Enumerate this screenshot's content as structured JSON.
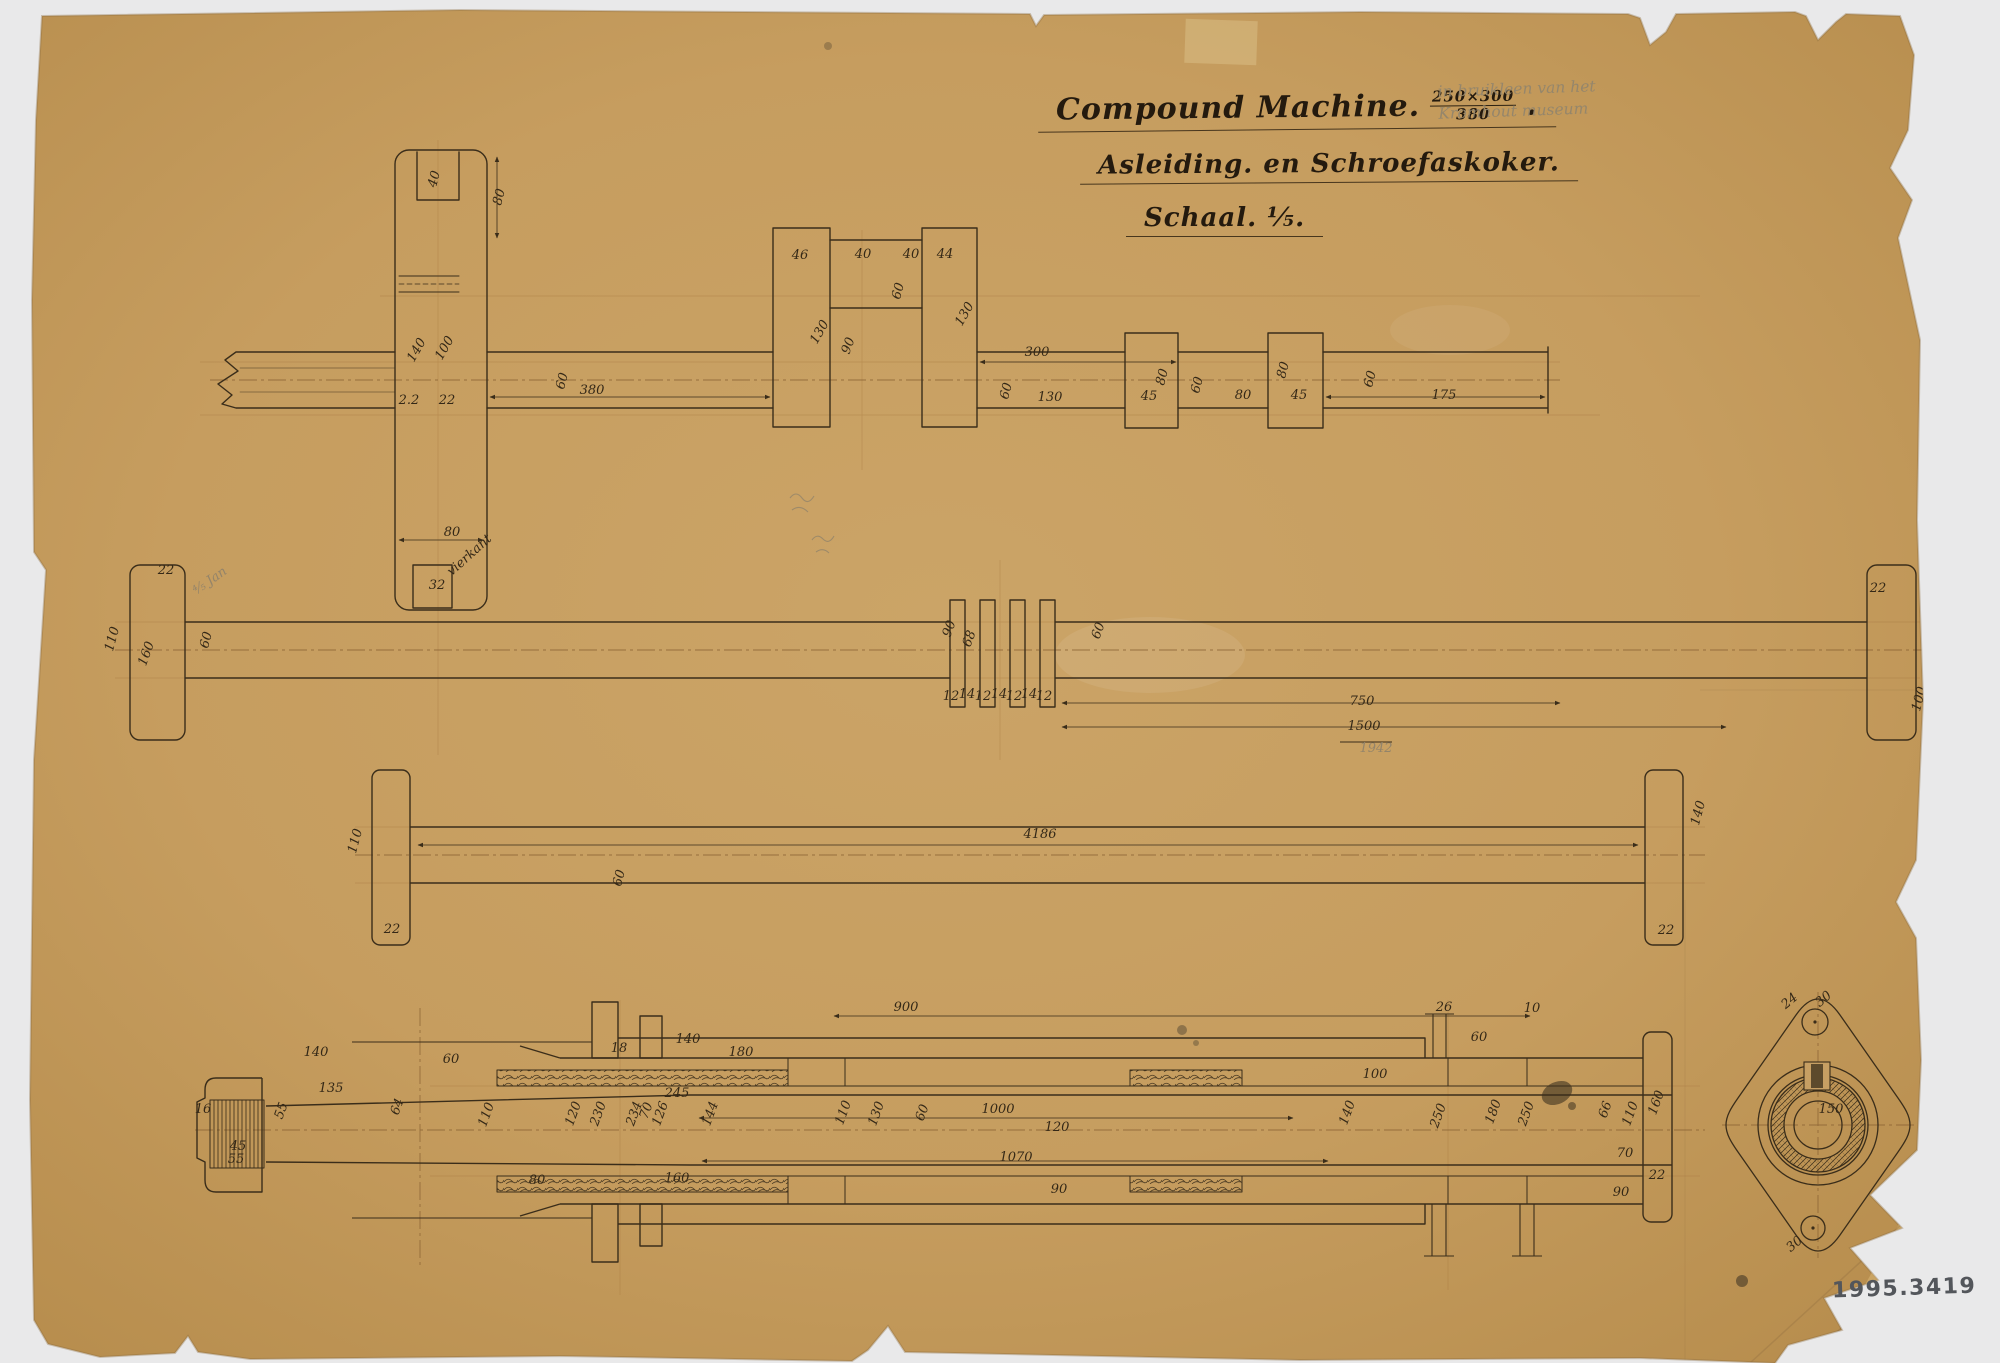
{
  "meta": {
    "inventory_number": "1995.3419"
  },
  "title": {
    "line1": "Compound Machine.",
    "fraction_top": "250×300",
    "fraction_bottom": "380",
    "line1_suffix": ".",
    "line2": "Asleiding. en Schroefaskoker.",
    "line3": "Schaal. ⅕."
  },
  "pencil_note": {
    "line1": "in bruikleen van het",
    "line2": "Kromhout museum"
  },
  "colors": {
    "paper": "#c79f63",
    "ink": "#3a2d1a",
    "pencil": "#93846a",
    "faint_line": "#a5763d"
  },
  "annotations": [
    {
      "t": "40",
      "x": 438,
      "y": 180,
      "r": -75
    },
    {
      "t": "80",
      "x": 503,
      "y": 198,
      "r": -75
    },
    {
      "t": "140",
      "x": 420,
      "y": 352,
      "r": -60
    },
    {
      "t": "100",
      "x": 448,
      "y": 350,
      "r": -60
    },
    {
      "t": "2.2",
      "x": 409,
      "y": 404
    },
    {
      "t": "22",
      "x": 447,
      "y": 404
    },
    {
      "t": "80",
      "x": 452,
      "y": 536
    },
    {
      "t": "32",
      "x": 437,
      "y": 589
    },
    {
      "t": "vierkant",
      "x": 472,
      "y": 558,
      "r": -42,
      "s": 9
    },
    {
      "t": "60",
      "x": 566,
      "y": 382,
      "r": -75
    },
    {
      "t": "380",
      "x": 592,
      "y": 394
    },
    {
      "t": "46",
      "x": 800,
      "y": 259
    },
    {
      "t": "40",
      "x": 863,
      "y": 258
    },
    {
      "t": "40",
      "x": 911,
      "y": 258
    },
    {
      "t": "44",
      "x": 945,
      "y": 258
    },
    {
      "t": "60",
      "x": 902,
      "y": 292,
      "r": -75
    },
    {
      "t": "130",
      "x": 823,
      "y": 334,
      "r": -60
    },
    {
      "t": "90",
      "x": 852,
      "y": 347,
      "r": -70
    },
    {
      "t": "130",
      "x": 968,
      "y": 316,
      "r": -60
    },
    {
      "t": "300",
      "x": 1037,
      "y": 356
    },
    {
      "t": "60",
      "x": 1010,
      "y": 392,
      "r": -75
    },
    {
      "t": "130",
      "x": 1050,
      "y": 401
    },
    {
      "t": "45",
      "x": 1149,
      "y": 400
    },
    {
      "t": "80",
      "x": 1166,
      "y": 378,
      "r": -75
    },
    {
      "t": "60",
      "x": 1201,
      "y": 386,
      "r": -75
    },
    {
      "t": "80",
      "x": 1243,
      "y": 399
    },
    {
      "t": "45",
      "x": 1299,
      "y": 399
    },
    {
      "t": "80",
      "x": 1287,
      "y": 371,
      "r": -75
    },
    {
      "t": "60",
      "x": 1374,
      "y": 380,
      "r": -75
    },
    {
      "t": "175",
      "x": 1444,
      "y": 399
    },
    {
      "t": "110",
      "x": 116,
      "y": 640,
      "r": -75
    },
    {
      "t": "22",
      "x": 166,
      "y": 574
    },
    {
      "t": "160",
      "x": 150,
      "y": 655,
      "r": -70
    },
    {
      "t": "60",
      "x": 210,
      "y": 641,
      "r": -75
    },
    {
      "t": "90",
      "x": 953,
      "y": 630,
      "r": -70
    },
    {
      "t": "68",
      "x": 973,
      "y": 640,
      "r": -70
    },
    {
      "t": "12",
      "x": 951,
      "y": 700,
      "s": 10
    },
    {
      "t": "14",
      "x": 967,
      "y": 698,
      "s": 10
    },
    {
      "t": "12",
      "x": 983,
      "y": 700,
      "s": 10
    },
    {
      "t": "14",
      "x": 999,
      "y": 698,
      "s": 10
    },
    {
      "t": "12",
      "x": 1014,
      "y": 700,
      "s": 10
    },
    {
      "t": "14",
      "x": 1029,
      "y": 698,
      "s": 10
    },
    {
      "t": "12",
      "x": 1044,
      "y": 700,
      "s": 10
    },
    {
      "t": "60",
      "x": 1102,
      "y": 632,
      "r": -70
    },
    {
      "t": "750",
      "x": 1362,
      "y": 705
    },
    {
      "t": "1500",
      "x": 1364,
      "y": 730
    },
    {
      "t": "1942",
      "x": 1376,
      "y": 752,
      "cls": "pencil",
      "s": 11
    },
    {
      "t": "⅘ Jan",
      "x": 212,
      "y": 584,
      "r": -35,
      "cls": "pencil",
      "s": 11
    },
    {
      "t": "22",
      "x": 1878,
      "y": 592
    },
    {
      "t": "100",
      "x": 1923,
      "y": 700,
      "r": -75
    },
    {
      "t": "110",
      "x": 359,
      "y": 842,
      "r": -75
    },
    {
      "t": "22",
      "x": 392,
      "y": 933
    },
    {
      "t": "60",
      "x": 623,
      "y": 879,
      "r": -75
    },
    {
      "t": "4186",
      "x": 1040,
      "y": 838
    },
    {
      "t": "140",
      "x": 1702,
      "y": 814,
      "r": -75
    },
    {
      "t": "22",
      "x": 1666,
      "y": 934
    },
    {
      "t": "16",
      "x": 203,
      "y": 1113
    },
    {
      "t": "45",
      "x": 238,
      "y": 1150
    },
    {
      "t": "55",
      "x": 236,
      "y": 1163
    },
    {
      "t": "55",
      "x": 285,
      "y": 1112,
      "r": -70
    },
    {
      "t": "135",
      "x": 331,
      "y": 1092
    },
    {
      "t": "64",
      "x": 401,
      "y": 1108,
      "r": -70
    },
    {
      "t": "140",
      "x": 316,
      "y": 1056
    },
    {
      "t": "60",
      "x": 451,
      "y": 1063
    },
    {
      "t": "110",
      "x": 490,
      "y": 1116,
      "r": -70
    },
    {
      "t": "18",
      "x": 619,
      "y": 1052,
      "s": 10
    },
    {
      "t": "140",
      "x": 688,
      "y": 1043
    },
    {
      "t": "180",
      "x": 741,
      "y": 1056
    },
    {
      "t": "245",
      "x": 677,
      "y": 1097
    },
    {
      "t": "120",
      "x": 577,
      "y": 1115,
      "r": -70
    },
    {
      "t": "230",
      "x": 602,
      "y": 1115,
      "r": -70
    },
    {
      "t": "234",
      "x": 638,
      "y": 1115,
      "r": -70
    },
    {
      "t": "70",
      "x": 650,
      "y": 1112,
      "r": -70
    },
    {
      "t": "126",
      "x": 664,
      "y": 1115,
      "r": -70
    },
    {
      "t": "144",
      "x": 714,
      "y": 1115,
      "r": -70
    },
    {
      "t": "110",
      "x": 847,
      "y": 1114,
      "r": -70
    },
    {
      "t": "130",
      "x": 880,
      "y": 1115,
      "r": -70
    },
    {
      "t": "60",
      "x": 926,
      "y": 1114,
      "r": -70
    },
    {
      "t": "80",
      "x": 537,
      "y": 1184
    },
    {
      "t": "160",
      "x": 677,
      "y": 1182
    },
    {
      "t": "900",
      "x": 906,
      "y": 1011
    },
    {
      "t": "1000",
      "x": 998,
      "y": 1113
    },
    {
      "t": "120",
      "x": 1057,
      "y": 1131
    },
    {
      "t": "1070",
      "x": 1016,
      "y": 1161
    },
    {
      "t": "90",
      "x": 1059,
      "y": 1193
    },
    {
      "t": "26",
      "x": 1444,
      "y": 1011,
      "s": 10
    },
    {
      "t": "10",
      "x": 1532,
      "y": 1012,
      "s": 10
    },
    {
      "t": "60",
      "x": 1479,
      "y": 1041
    },
    {
      "t": "100",
      "x": 1375,
      "y": 1078
    },
    {
      "t": "140",
      "x": 1351,
      "y": 1114,
      "r": -70
    },
    {
      "t": "250",
      "x": 1442,
      "y": 1117,
      "r": -70
    },
    {
      "t": "180",
      "x": 1497,
      "y": 1113,
      "r": -70
    },
    {
      "t": "250",
      "x": 1530,
      "y": 1115,
      "r": -70
    },
    {
      "t": "66",
      "x": 1609,
      "y": 1111,
      "r": -70
    },
    {
      "t": "110",
      "x": 1634,
      "y": 1115,
      "r": -70
    },
    {
      "t": "160",
      "x": 1660,
      "y": 1104,
      "r": -70
    },
    {
      "t": "70",
      "x": 1625,
      "y": 1157
    },
    {
      "t": "22",
      "x": 1657,
      "y": 1179
    },
    {
      "t": "90",
      "x": 1621,
      "y": 1196
    },
    {
      "t": "24",
      "x": 1792,
      "y": 1004,
      "r": -40,
      "s": 10
    },
    {
      "t": "30",
      "x": 1826,
      "y": 1002,
      "r": -40,
      "s": 10
    },
    {
      "t": "150",
      "x": 1831,
      "y": 1113
    },
    {
      "t": "30",
      "x": 1797,
      "y": 1247,
      "r": -40,
      "s": 10
    }
  ]
}
